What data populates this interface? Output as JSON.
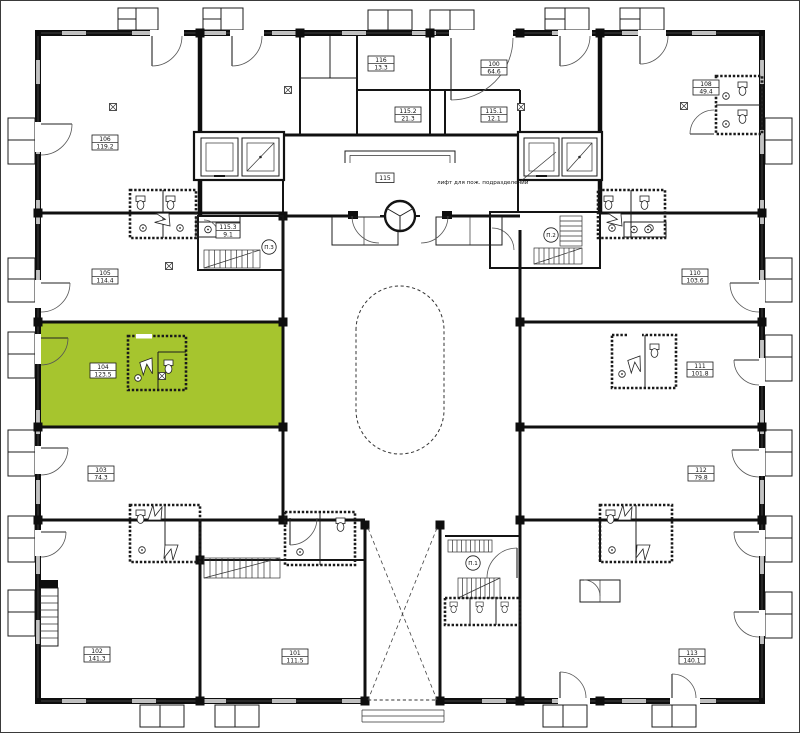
{
  "plan": {
    "highlight_color": "#a6c52e",
    "wall_color": "#101010",
    "background": "#ffffff"
  },
  "rooms": [
    {
      "number": "106",
      "area": "119.2"
    },
    {
      "number": "105",
      "area": "114.4"
    },
    {
      "number": "104",
      "area": "123.5",
      "highlighted": true
    },
    {
      "number": "103",
      "area": "74.3"
    },
    {
      "number": "102",
      "area": "141.3"
    },
    {
      "number": "101",
      "area": "111.5"
    },
    {
      "number": "116",
      "area": "13.3"
    },
    {
      "number": "100",
      "area": "64.6"
    },
    {
      "number": "115.2",
      "area": "21.3"
    },
    {
      "number": "115.1",
      "area": "12.1"
    },
    {
      "number": "115",
      "area": ""
    },
    {
      "number": "115.3",
      "area": "9.1"
    },
    {
      "number": "108",
      "area": "49.4"
    },
    {
      "number": "110",
      "area": "103.6"
    },
    {
      "number": "111",
      "area": "101.8"
    },
    {
      "number": "112",
      "area": "79.8"
    },
    {
      "number": "113",
      "area": "140.1"
    }
  ],
  "stairs": [
    {
      "label": "П.1"
    },
    {
      "label": "П.2"
    },
    {
      "label": "П.3"
    }
  ],
  "annotations": {
    "fire_elevator": "лифт для пож. подразделений"
  }
}
